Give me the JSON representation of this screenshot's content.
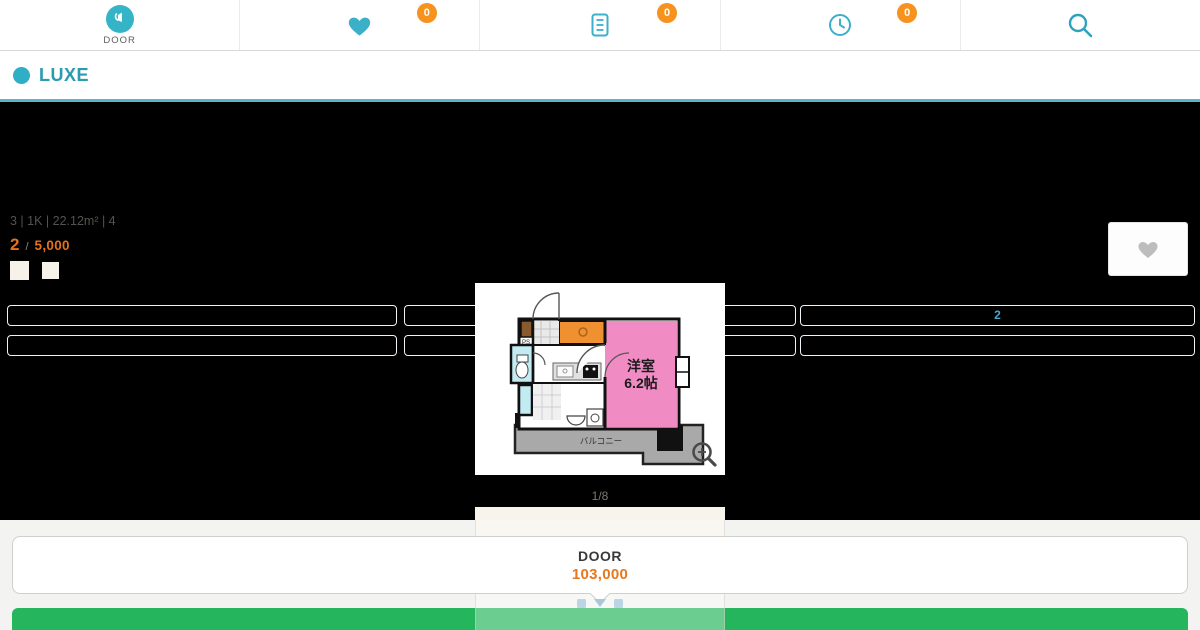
{
  "header": {
    "logo": {
      "label": "DOOR"
    },
    "nav": [
      {
        "icon": "heart-icon",
        "badge": "0"
      },
      {
        "icon": "document-icon",
        "badge": "0"
      },
      {
        "icon": "clock-icon",
        "badge": "0"
      },
      {
        "icon": "search-icon"
      }
    ]
  },
  "title_bar": {
    "title": "LUXE"
  },
  "property": {
    "summary": "3 | 1K | 22.12m² | 4",
    "rank_number": "2",
    "rank_separator": "/",
    "rank_value": "5,000",
    "detail_boxes": [
      "",
      "",
      "2",
      "",
      "",
      ""
    ]
  },
  "gallery": {
    "counter": "1/8",
    "floorplan": {
      "room_label": "洋室",
      "room_size": "6.2帖",
      "balcony_label": "バルコニー",
      "ps_label": "PS"
    }
  },
  "footer": {
    "card_title": "DOOR",
    "card_price": "103,000"
  },
  "colors": {
    "brand_teal": "#35b4c8",
    "badge_orange": "#f6921e",
    "price_orange": "#e4711c",
    "cta_green": "#25b55c",
    "room_pink": "#f08cc3",
    "closet_orange": "#ef9130",
    "bath_cyan": "#c2ecf2"
  }
}
